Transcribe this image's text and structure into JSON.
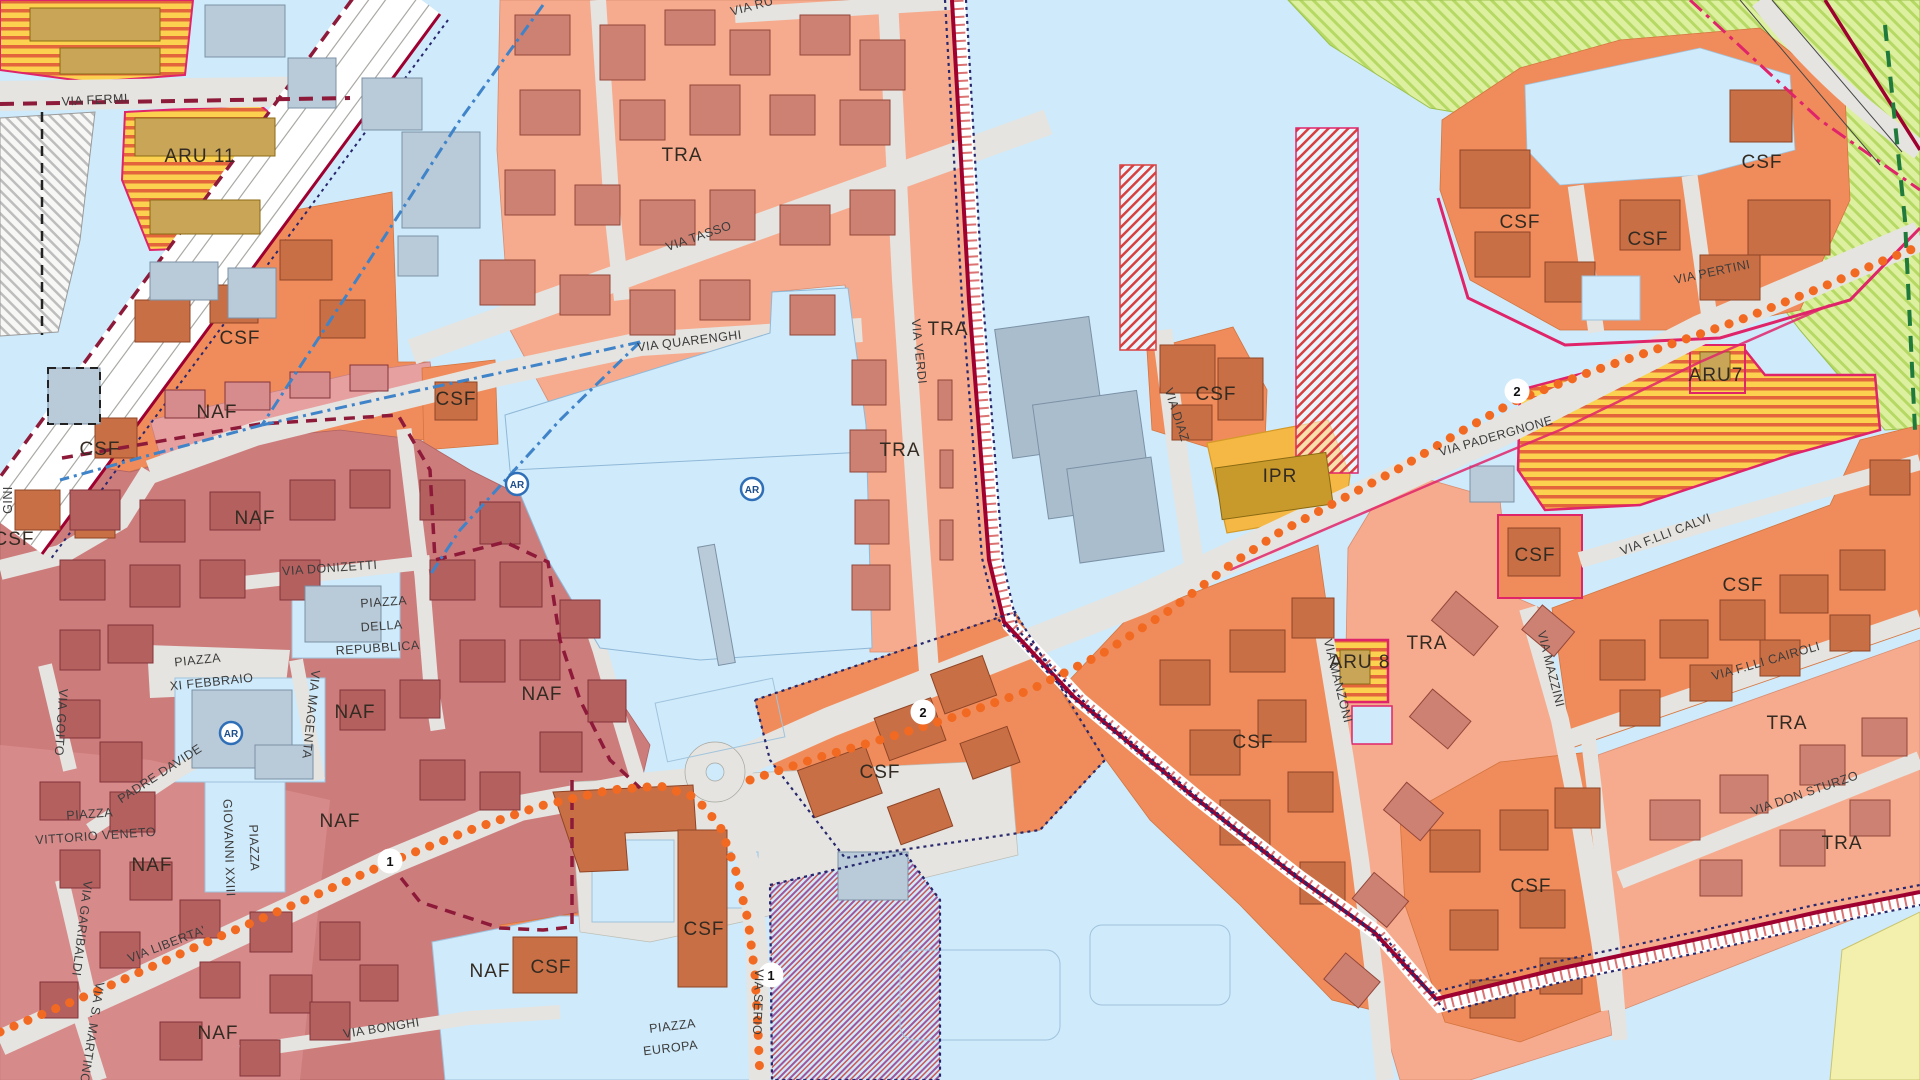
{
  "map": {
    "kind": "urban-zoning-plan-map",
    "zone_labels": [
      "ARU 11",
      "CSF",
      "CSF",
      "CSF",
      "NAF",
      "NAF",
      "NAF",
      "NAF",
      "NAF",
      "NAF",
      "NAF",
      "NAF",
      "CSF",
      "CSF",
      "CSF",
      "CSF",
      "TRA",
      "TRA",
      "TRA",
      "CSF",
      "IPR",
      "CSF",
      "CSF",
      "CSF",
      "ARU7",
      "ARU 8",
      "CSF",
      "TRA",
      "CSF",
      "CSF",
      "TRA",
      "CSF",
      "TRA"
    ],
    "street_labels": [
      "VIA FERMI",
      "VIA TASSO",
      "VIA QUARENGHI",
      "VIA VERDI",
      "VIA RU",
      "VIA DONIZETTI",
      "VIA MAGENTA",
      "VIA GOITO",
      "PADRE DAVIDE",
      "PIAZZA",
      "XI FEBBRAIO",
      "PIAZZA",
      "DELLA",
      "REPUBBLICA",
      "PIAZZA",
      "VITTORIO VENETO",
      "PIAZZA",
      "GIOVANNI XXIII",
      "VIA GARIBALDI",
      "VIA LIBERTA'",
      "VIA S. MARTINO",
      "VIA BONGHI",
      "VIA SERIO",
      "PIAZZA",
      "EUROPA",
      "VIA DIAZ",
      "VIA PADERGNONE",
      "VIA PERTINI",
      "VIA MANZONI",
      "VIA MAZZINI",
      "VIA F.LLI CALVI",
      "VIA F.LLI CAIROLI",
      "VIA DON STURZO",
      "GINI"
    ],
    "markers": {
      "ar": "AR",
      "route1": "1",
      "route2": "2"
    },
    "colors": {
      "background_water": "#cfeafa",
      "tra_zone": "#f6ab8e",
      "csf_zone": "#f08c5c",
      "naf_zone": "#cd7c7c",
      "naf_light": "#e7a0a0",
      "aru_yellow": "#fcd14f",
      "aru_stripe": "#e2653c",
      "ipr_gold": "#f6b844",
      "green_zone": "#ddf09f",
      "pale_yellow": "#f3f0ad",
      "road_gray": "#e5e4e0",
      "building_gray": "#b9cad9",
      "route_dots_orange": "#f26a22",
      "boundary_maroon": "#9e0030",
      "boundary_navy": "#27276e",
      "boundary_magenta": "#e0246a",
      "canal_blue": "#3f83c9"
    }
  }
}
